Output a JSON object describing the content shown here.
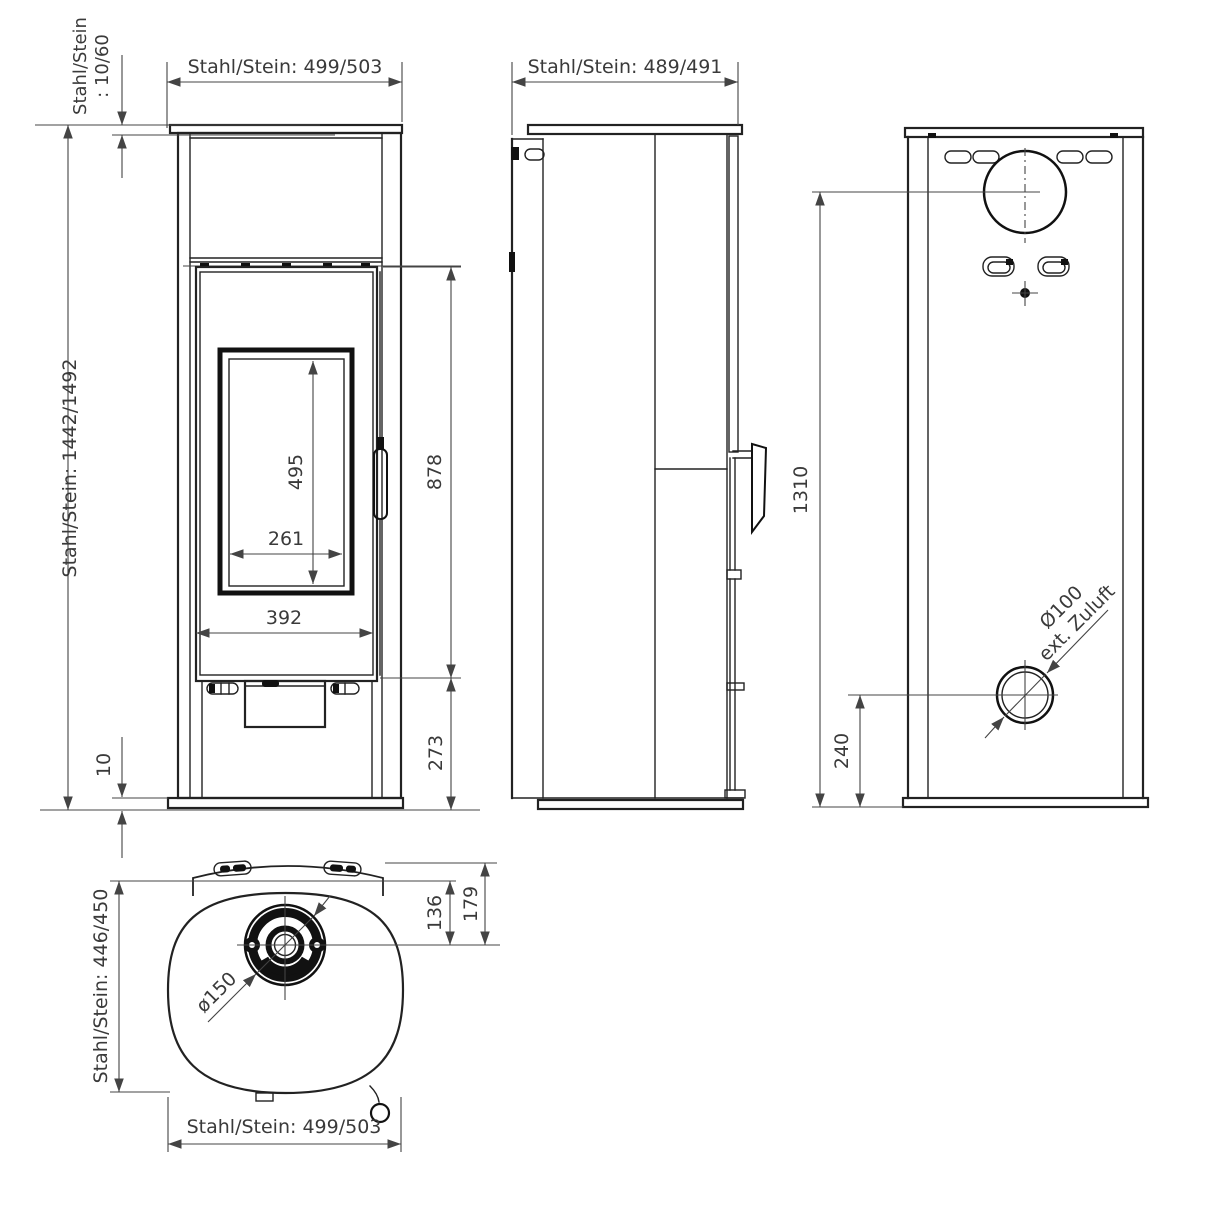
{
  "drawing": {
    "front_view": {
      "width_dim": "Stahl/Stein: 499/503",
      "height_dim": "Stahl/Stein: 1442/1492",
      "top_plate_dim_line1": "Stahl/Stein",
      "top_plate_dim_line2": ": 10/60",
      "door_area_height_dim": "878",
      "glass_height_dim": "495",
      "glass_width_dim": "261",
      "door_width_dim": "392",
      "plinth_height_dim": "273",
      "base_gap_dim": "10"
    },
    "side_view": {
      "depth_dim": "Stahl/Stein: 489/491"
    },
    "back_view": {
      "flue_center_height_dim": "1310",
      "air_inlet_height_dim": "240",
      "air_inlet_label_line1": "Ø100",
      "air_inlet_label_line2": "ext. Zuluft"
    },
    "top_view": {
      "depth_dim": "Stahl/Stein: 446/450",
      "width_dim": "Stahl/Stein: 499/503",
      "flue_diameter_label": "ø150",
      "flue_to_backplate_dim": "136",
      "flue_to_back_edge_dim": "179"
    }
  }
}
